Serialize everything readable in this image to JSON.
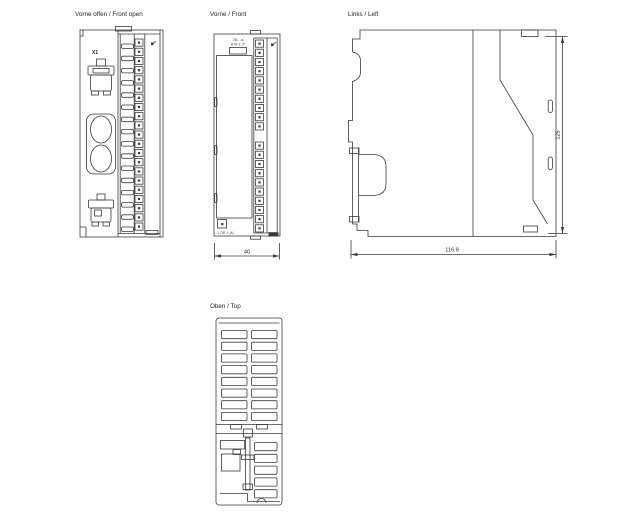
{
  "colors": {
    "background": "#ffffff",
    "line": "#3a3a3a",
    "text": "#1e1e1e"
  },
  "views": {
    "front_open": {
      "label": "Vorne offen / Front open",
      "connector_label": "X1"
    },
    "front": {
      "label": "Vorne / Front",
      "module_print_line1": "-7M- -a-",
      "module_print_line2": "A=6-2.!T",
      "order_print": ":-L7!E-+-Al-",
      "width_dimension": "40"
    },
    "left": {
      "label": "Links / Left",
      "depth_dimension": "116.9",
      "height_dimension": "125"
    },
    "top": {
      "label": "Oben / Top"
    }
  },
  "icons": {
    "screw_mark": "screw-mark-icon"
  }
}
